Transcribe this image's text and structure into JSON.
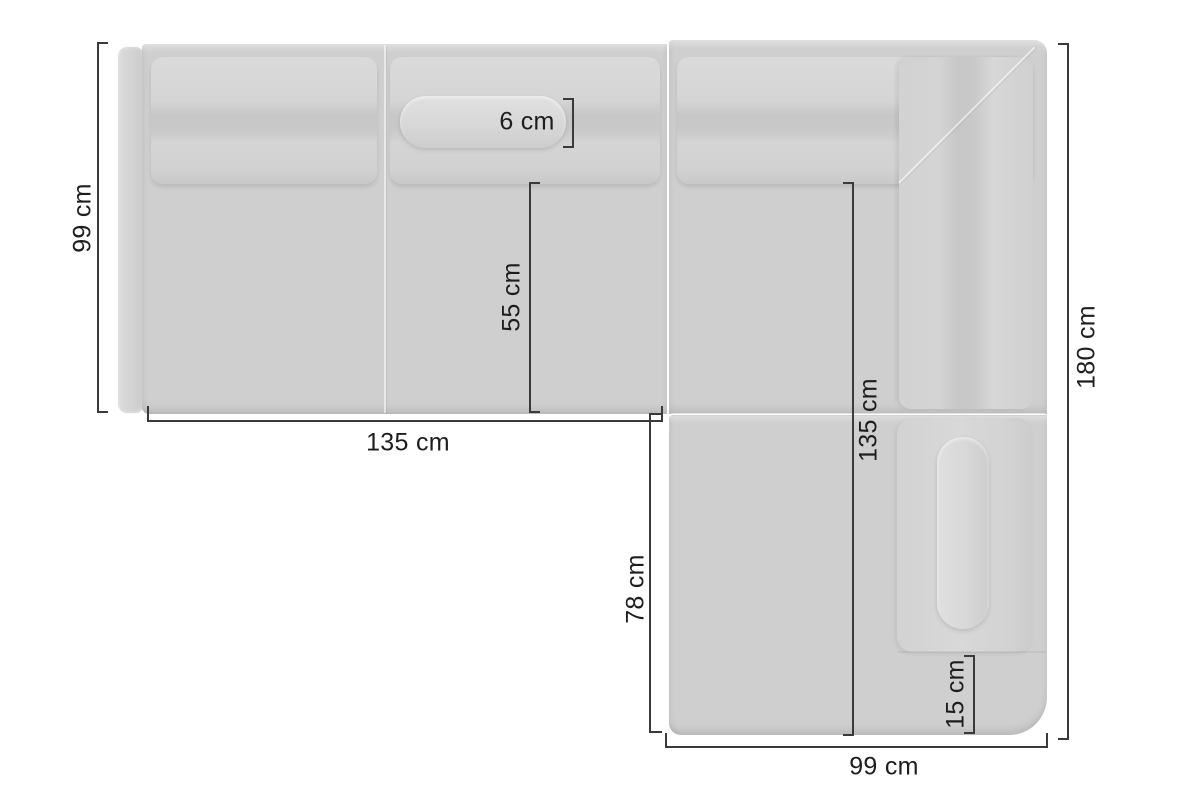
{
  "diagram": {
    "kind": "corner-sofa-top-view-dimensions",
    "unit": "cm",
    "dimensions": {
      "side_depth": {
        "label": "99 cm",
        "value": 99,
        "orientation": "vertical",
        "position": "left-of-sofa"
      },
      "section_width": {
        "label": "135 cm",
        "value": 135,
        "orientation": "horizontal",
        "position": "below-left-section"
      },
      "roll_cushion": {
        "label": "6 cm",
        "value": 6,
        "orientation": "vertical-bracket",
        "position": "on-back-bolster"
      },
      "seat_depth": {
        "label": "55 cm",
        "value": 55,
        "orientation": "vertical",
        "position": "on-left-seat"
      },
      "inner_length": {
        "label": "135 cm",
        "value": 135,
        "orientation": "vertical",
        "position": "on-right-section"
      },
      "total_length": {
        "label": "180 cm",
        "value": 180,
        "orientation": "vertical",
        "position": "right-of-sofa"
      },
      "chaise_length": {
        "label": "78 cm",
        "value": 78,
        "orientation": "vertical",
        "position": "left-of-chaise"
      },
      "base_height": {
        "label": "15 cm",
        "value": 15,
        "orientation": "vertical-bracket",
        "position": "on-chaise-base"
      },
      "chaise_width": {
        "label": "99 cm",
        "value": 99,
        "orientation": "horizontal",
        "position": "below-chaise"
      }
    }
  },
  "colors": {
    "bg": "#ffffff",
    "sofa": "#cfcfcf",
    "sofa-light": "#d9d9d9",
    "sofa-shadow": "#c7c7c7",
    "line": "#3a3a3a",
    "text": "#1d1d1d"
  }
}
